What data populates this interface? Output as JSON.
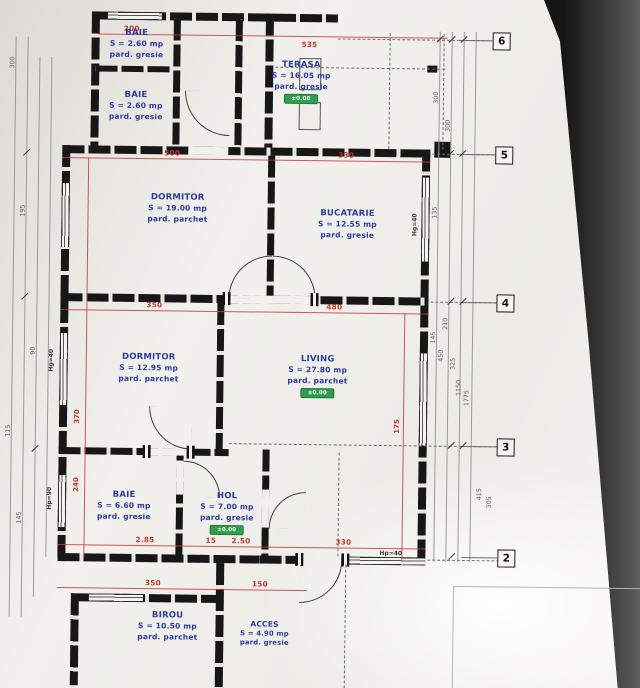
{
  "drawing_title": "floor plan photo",
  "colors": {
    "paper": "#f2f1ed",
    "wall": "#17171a",
    "dimension_red": "#c0392b",
    "label_blue": "#2b3aa0",
    "badge_green": "#2f9e4f"
  },
  "rooms": [
    {
      "name": "BAIE",
      "area": "S = 2.60 mp",
      "floor": "pard. gresie",
      "badge": null
    },
    {
      "name": "BAIE",
      "area": "S = 2.60 mp",
      "floor": "pard. gresie",
      "badge": null
    },
    {
      "name": "TERASA",
      "area": "S = 16.05 mp",
      "floor": "pard. gresie",
      "badge": "±0.00"
    },
    {
      "name": "DORMITOR",
      "area": "S = 19.00 mp",
      "floor": "pard. parchet",
      "badge": null
    },
    {
      "name": "BUCATARIE",
      "area": "S = 12.55 mp",
      "floor": "pard. gresie",
      "badge": null
    },
    {
      "name": "DORMITOR",
      "area": "S = 12.95 mp",
      "floor": "pard. parchet",
      "badge": null
    },
    {
      "name": "LIVING",
      "area": "S = 27.80 mp",
      "floor": "pard. parchet",
      "badge": "±0.00"
    },
    {
      "name": "BAIE",
      "area": "S = 6.60 mp",
      "floor": "pard. gresie",
      "badge": null
    },
    {
      "name": "HOL",
      "area": "S = 7.00 mp",
      "floor": "pard. gresie",
      "badge": "±0.00"
    },
    {
      "name": "BIROU",
      "area": "S = 10.50 mp",
      "floor": "pard. parchet",
      "badge": null
    },
    {
      "name": "ACCES",
      "area": "S = 4.90 mp",
      "floor": "pard. gresie",
      "badge": null
    }
  ],
  "grid": [
    "6",
    "5",
    "4",
    "3",
    "2"
  ],
  "dims": {
    "red": [
      "200",
      "535",
      "500",
      "330",
      "350",
      "480",
      "2.85",
      "15",
      "2.50",
      "330",
      "350",
      "150"
    ],
    "red_rot": [
      "370",
      "240",
      "175"
    ],
    "left_chain": [
      "300",
      "195",
      "90",
      "115",
      "145"
    ],
    "right_chain": [
      "300",
      "300",
      "135",
      "145",
      "210",
      "450",
      "325",
      "1150",
      "1775",
      "415",
      "305"
    ],
    "sills": [
      "Hg=40",
      "Hp=90",
      "Hp=40",
      "Hg=40"
    ]
  }
}
